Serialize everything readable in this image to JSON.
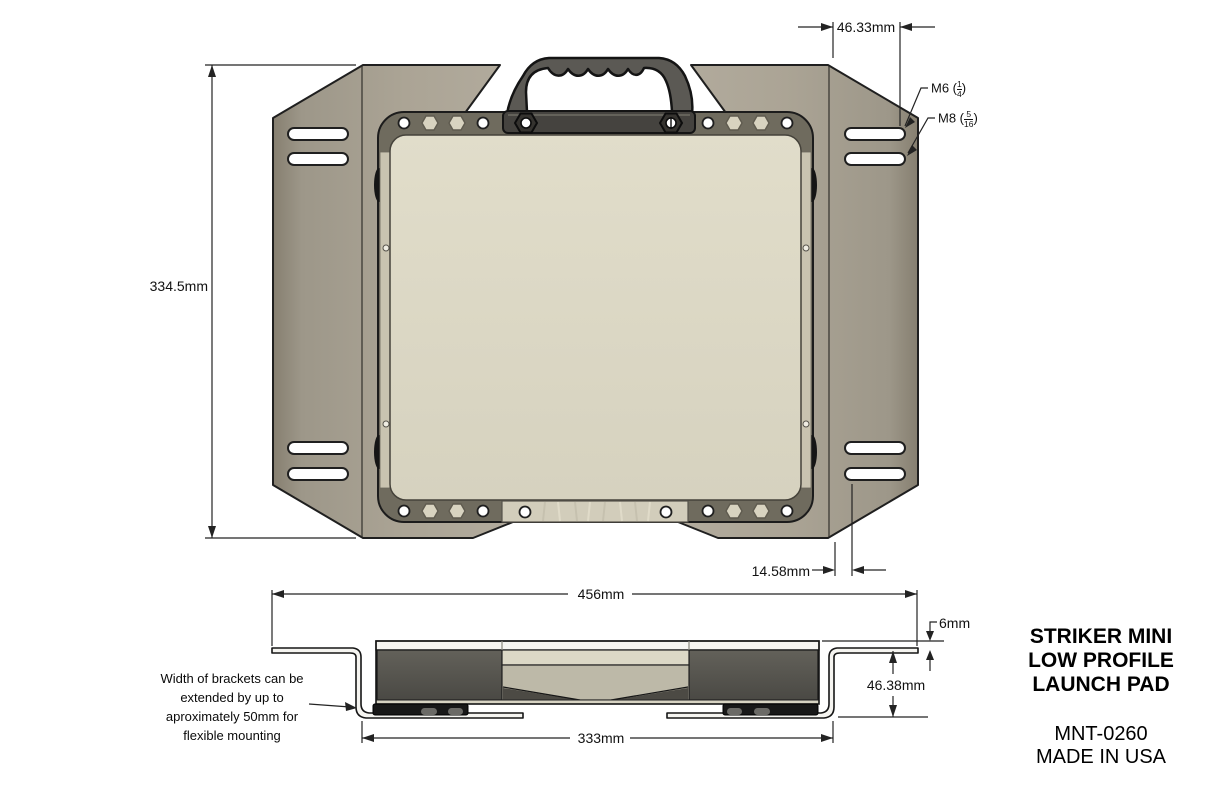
{
  "title_block": {
    "product_line1": "STRIKER MINI",
    "product_line2": "LOW PROFILE",
    "product_line3": "LAUNCH PAD",
    "part_number": "MNT-0260",
    "origin": "MADE IN USA"
  },
  "dimensions": {
    "slot_span_top": "46.33mm",
    "overall_depth": "334.5mm",
    "slot_offset_bottom": "14.58mm",
    "overall_width": "456mm",
    "top_plate_thickness": "6mm",
    "profile_height": "46.38mm",
    "mount_base_width": "333mm"
  },
  "thread_callouts": {
    "m6": {
      "prefix": "M6 (",
      "numerator": "1",
      "denominator": "4",
      "suffix": ")"
    },
    "m8": {
      "prefix": "M8 (",
      "numerator": "5",
      "denominator": "16",
      "suffix": ")"
    }
  },
  "notes": {
    "bracket_note": "Width of brackets can be\nextended by up to\naproximately 50mm for\nflexible mounting"
  },
  "colors": {
    "wing_tan": "#a9a294",
    "plate_cream": "#dcd8c5",
    "frame_olive": "#6f6b5e",
    "handle_gray": "#5b5954",
    "base_black": "#181818",
    "line": "#232323"
  }
}
